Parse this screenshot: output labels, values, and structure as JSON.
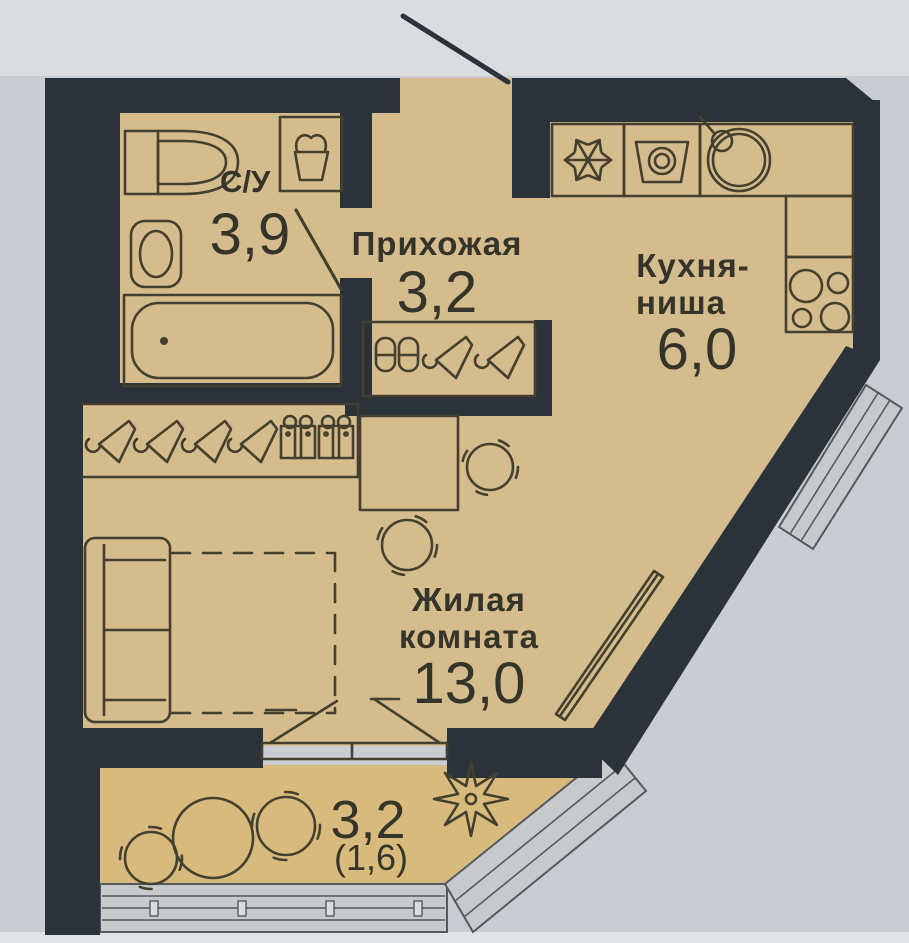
{
  "page": {
    "type": "apartment-floor-plan-photo",
    "language": "ru"
  },
  "rooms": {
    "bathroom": {
      "label": "С/У",
      "area": "3,9"
    },
    "hallway": {
      "label": "Прихожая",
      "area": "3,2"
    },
    "kitchen": {
      "label_line1": "Кухня-",
      "label_line2": "ниша",
      "area": "6,0"
    },
    "living_room": {
      "label_line1": "Жилая",
      "label_line2": "комната",
      "area": "13,0"
    },
    "balcony": {
      "area": "3,2",
      "area_secondary": "(1,6)"
    }
  },
  "icons": {
    "bathroom": [
      "sink-icon",
      "laundry-basket-icon",
      "toilet-icon",
      "bathtub-icon"
    ],
    "hallway": [
      "shoe-cabinet-icon",
      "hanger-icon",
      "entrance-door",
      "interior-door"
    ],
    "kitchen": [
      "fridge-snowflake-icon",
      "washing-machine-icon",
      "kitchen-sink-icon",
      "stove-burners-icon"
    ],
    "living_room": [
      "hanger-icon",
      "storage-box-icon",
      "desk",
      "chair-icon",
      "sofa",
      "bed-zone-dashed",
      "radiator",
      "diagonal-window"
    ],
    "balcony": [
      "round-table-icon",
      "chair-icon",
      "plant-icon",
      "balcony-glazing",
      "balcony-door"
    ]
  },
  "colors": {
    "wall": "#2b323a",
    "floor": "#d5bc8d",
    "floor_balcony": "#d9ba7d",
    "line": "#43402f",
    "text": "#35342a",
    "background": "#c9cdd2",
    "background_top": "#dadcdf",
    "background_bottom": "#e2e3e5",
    "glazing": "#c7cacd",
    "glazing_line": "#555a60"
  }
}
